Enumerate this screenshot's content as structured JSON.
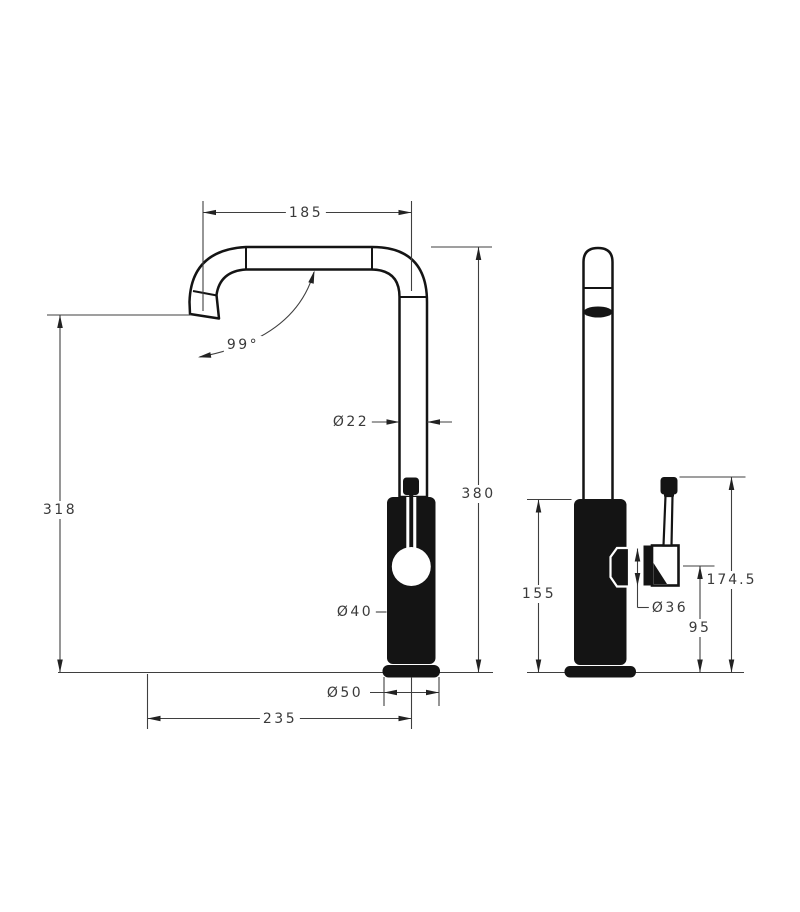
{
  "drawing": {
    "type": "technical-drawing",
    "subject": "kitchen mixer tap, front and side elevation with dimensions",
    "background_color": "#ffffff",
    "object_line_color": "#141414",
    "dimension_line_color": "#3f3f3f",
    "text_color": "#3a3a3a",
    "labels": {
      "spout_reach": "185",
      "spout_angle": "99°",
      "tube_diameter": "Ø22",
      "overall_height": "380",
      "outlet_height": "318",
      "body_diameter": "Ø40",
      "base_diameter": "Ø50",
      "outlet_reach": "235",
      "body_height": "155",
      "cartridge_diameter": "Ø36",
      "handle_pivot_height": "95",
      "handle_top_height": "174.5"
    }
  }
}
